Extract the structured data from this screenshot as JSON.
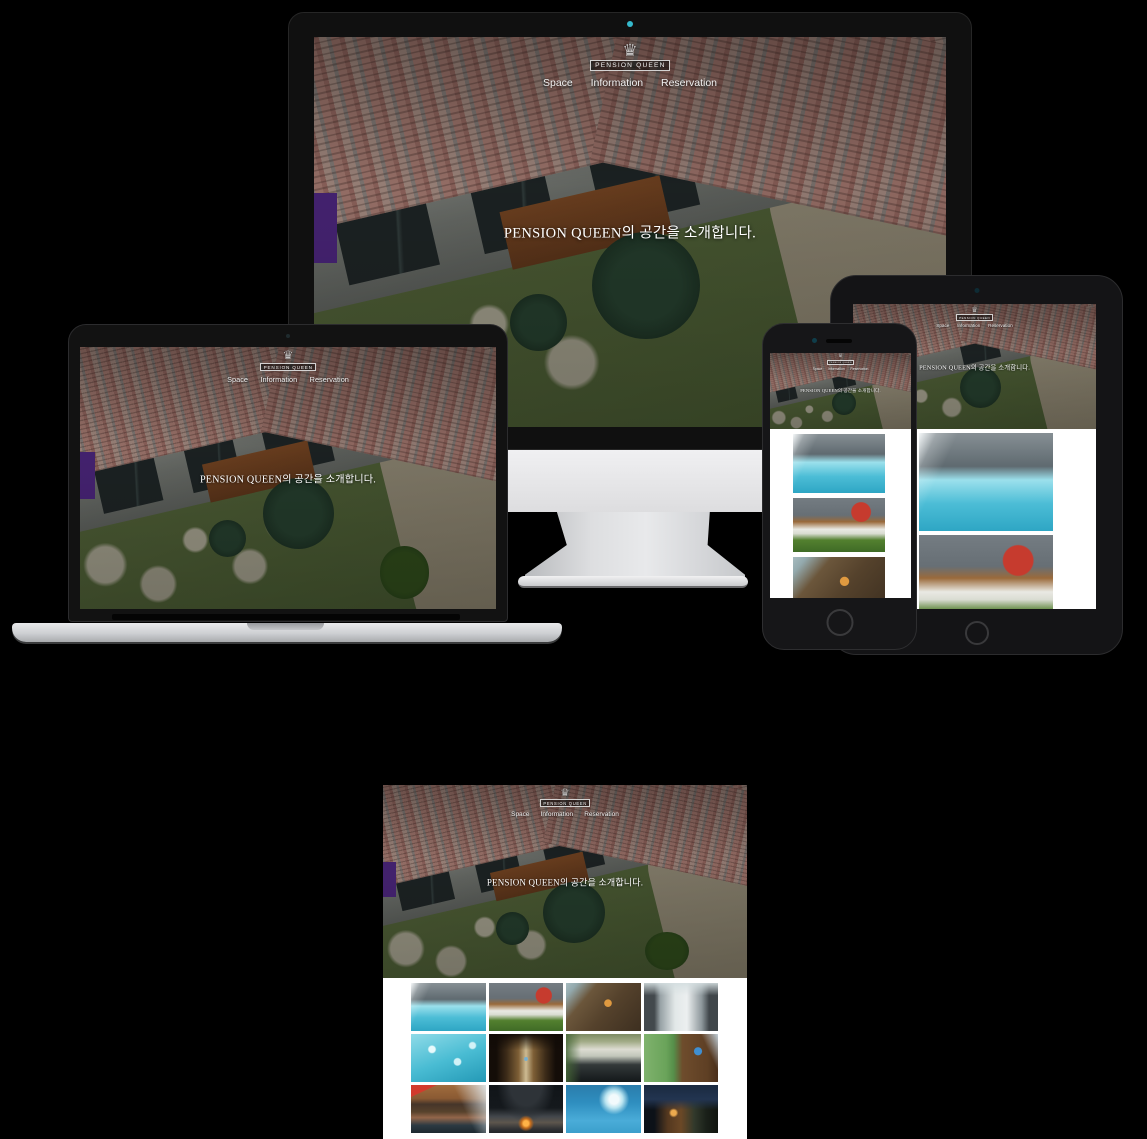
{
  "canvas": {
    "background": "#000000"
  },
  "site": {
    "logo": {
      "label": "PENSION QUEEN",
      "crest_glyph": "♛"
    },
    "nav": [
      {
        "label": "Space"
      },
      {
        "label": "Information"
      },
      {
        "label": "Reservation"
      }
    ],
    "hero": {
      "heading": "PENSION QUEEN의 공간을 소개합니다."
    },
    "accent_colors": {
      "webcam_dot": "#35b9cc",
      "hero_text": "#ffffff",
      "gallery_background": "#ffffff"
    }
  },
  "gallery": {
    "items": [
      {
        "name": "pool-waterfall",
        "bg": "linear-gradient(115deg, rgba(250,253,254,0.95) 0%, rgba(250,253,254,0.25) 10%, rgba(250,253,254,0) 22%), linear-gradient(180deg, #868f94 0%, #5f6a70 34%, #9be0ec 48%, #4cbdd6 72%, #2ea6c4 100%)"
      },
      {
        "name": "lawn-loungers-red-parasol",
        "bg": "radial-gradient(circle at 74% 26%, #c63b2e 0 12%, rgba(198,59,46,0) 13%), linear-gradient(180deg, #747c82 0%, #676f75 32%, #9a6a3b 44%, #e9e9e3 58%, #d9dcd2 66%, #53802f 78%, #3f6b26 100%)"
      },
      {
        "name": "pension-queen-sign-wall",
        "bg": "radial-gradient(circle at 56% 42%, #e09a40 0 7%, rgba(224,154,64,0) 8%), linear-gradient(130deg, #a7bcc0 0%, #93a9ad 10%, #6b563b 28%, #55422c 55%, #3d2f20 100%)"
      },
      {
        "name": "courtyard-loungers-alley",
        "bg": "linear-gradient(180deg, rgba(212,222,224,0.9) 0%, rgba(212,222,224,0) 26%), linear-gradient(90deg, #43494d 0%, #43494d 14%, #97a1a5 22%, #e2e8e8 42%, #eceff0 58%, #8d979b 78%, #40464a 88%, #40464a 100%)"
      },
      {
        "name": "sparkling-pool-water",
        "bg": "radial-gradient(circle at 28% 32%, #e8fafc 0 5%, rgba(232,250,252,0) 7%), radial-gradient(circle at 62% 58%, #d2f2f7 0 6%, rgba(210,242,247,0) 8%), radial-gradient(circle at 82% 24%, #d2f2f7 0 4%, rgba(210,242,247,0) 6%), linear-gradient(160deg, #8fdbe8 0%, #49bcd3 52%, #2499b6 100%)"
      },
      {
        "name": "wood-corridor-lights",
        "bg": "linear-gradient(180deg, rgba(16,10,6,0.95) 0%, rgba(16,10,6,0) 34%), radial-gradient(circle at 50% 52%, #79b0cf 0 4%, rgba(121,176,207,0) 5%), linear-gradient(90deg, #140d08 0%, #140d08 10%, #3d2c19 24%, #7e5f36 40%, #cdbb92 50%, #7e5f36 60%, #3d2c19 76%, #140d08 90%, #140d08 100%)"
      },
      {
        "name": "glass-terrace-reflection",
        "bg": "linear-gradient(90deg, rgba(70,103,55,0.85) 0%, rgba(70,103,55,0) 20%), linear-gradient(180deg, #7c8a62 0%, #a3ac88 16%, #dddcd2 32%, #c2c6ba 46%, #33393a 64%, #131819 100%)"
      },
      {
        "name": "resort-sign-hillside",
        "bg": "linear-gradient(245deg, rgba(208,226,238,0.9) 0%, rgba(208,226,238,0) 18%), radial-gradient(circle at 73% 36%, #3f8fd1 0 6%, rgba(63,143,209,0) 7%), linear-gradient(90deg, #7fb26d 0%, #6aa35a 30%, #568f4a 40%, #6e4c2c 52%, #5e3f24 86%, #4a2f1a 100%)"
      },
      {
        "name": "red-awning-entrance",
        "bg": "linear-gradient(245deg, rgba(223,231,235,0.95) 0%, rgba(223,231,235,0) 34%), linear-gradient(155deg, #d23b2c 0 14%, rgba(210,59,44,0) 15%), linear-gradient(180deg, #a06c3d 0%, #8a5a33 28%, #46352a 40%, #58422c 56%, #93664a 68%, #2c3a42 84%, #1d2930 100%)"
      },
      {
        "name": "night-dome-firepit",
        "bg": "radial-gradient(circle at 50% 80%, #ffb347 0 5%, #c06a1c 9%, rgba(192,106,28,0) 15%), radial-gradient(ellipse at 50% 0%, #2e3338 0 30%, rgba(46,51,56,0) 55%), linear-gradient(180deg, #101418 0%, #15191d 48%, #43474c 66%, #5d564d 78%, #2f3134 92%, #232528 100%)"
      },
      {
        "name": "pool-splash",
        "bg": "radial-gradient(circle at 64% 30%, #f2fafc 0 8%, #b9e4f0 15%, rgba(185,228,240,0) 26%), linear-gradient(180deg, #2a7cab 0%, #2f8fc0 38%, #4aacd8 74%, #3b9fcc 100%)"
      },
      {
        "name": "night-exterior-lights",
        "bg": "linear-gradient(180deg, #1a2a40 0%, #223450 30%, rgba(34,52,80,0) 52%), radial-gradient(circle at 40% 58%, #edaa4e 0 5%, rgba(237,170,78,0) 9%), linear-gradient(90deg, #0c1118 0%, #0c1118 14%, #54381f 32%, #6b4826 50%, #31392b 68%, #1a2019 84%, #10140f 100%)"
      }
    ]
  }
}
